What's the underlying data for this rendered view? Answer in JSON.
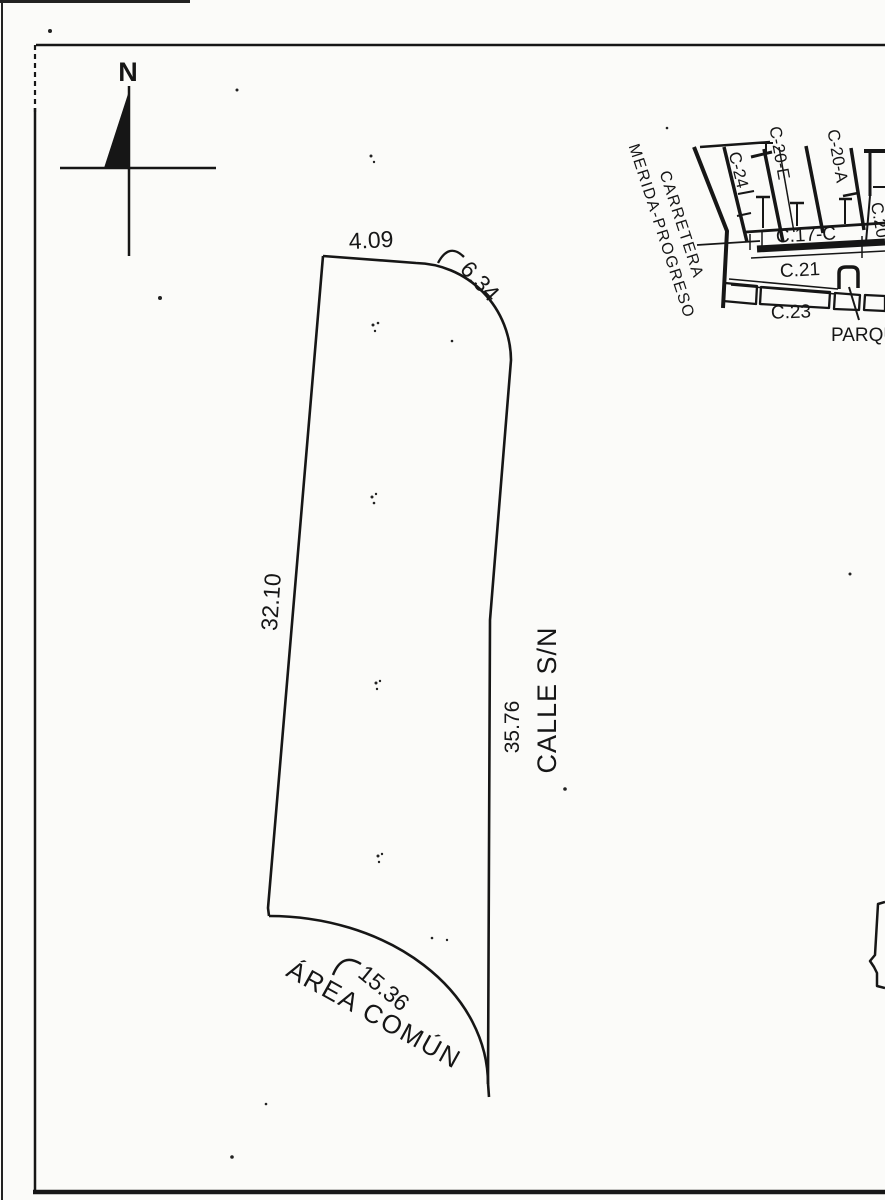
{
  "colors": {
    "ink": "#161616",
    "paper": "#fbfbf9"
  },
  "compass": {
    "north_label": "N"
  },
  "parcel": {
    "street_label": "CALLE S/N",
    "area_label": "ÁREA COMÚN",
    "dim_top": "4.09",
    "dim_top_curve": "6.34",
    "dim_left": "32.10",
    "dim_right": "35.76",
    "dim_bottom_curve": "15.36"
  },
  "inset_map": {
    "highway_label": "CARRETERA\nMERIDA-PROGRESO",
    "streets": {
      "c24": "C-24",
      "c20e": "C-20-E",
      "c20a": "C-20-A",
      "c20": "C.20",
      "c17c": "C.17-C",
      "c21": "C.21",
      "c23": "C.23"
    },
    "park_label": "PARQUE"
  }
}
